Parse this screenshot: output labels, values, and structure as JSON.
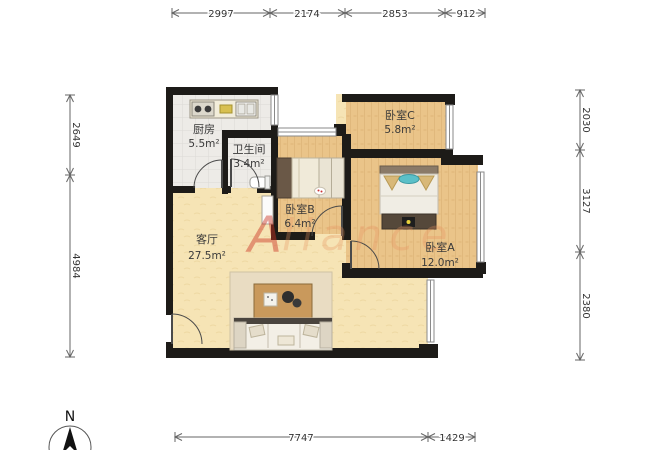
{
  "rooms": {
    "kitchen": {
      "name": "厨房",
      "area": "5.5m²"
    },
    "bathroom": {
      "name": "卫生间",
      "area": "3.4m²"
    },
    "bedroom_c": {
      "name": "卧室C",
      "area": "5.8m²"
    },
    "bedroom_b": {
      "name": "卧室B",
      "area": "6.4m²"
    },
    "bedroom_a": {
      "name": "卧室A",
      "area": "12.0m²"
    },
    "living_room": {
      "name": "客厅",
      "area": "27.5m²"
    }
  },
  "dimensions": {
    "top": [
      "2997",
      "2174",
      "2853",
      "912"
    ],
    "right": [
      "2030",
      "3127",
      "2380"
    ],
    "left": [
      "2649",
      "4984"
    ],
    "bottom": [
      "7747",
      "1429"
    ]
  },
  "compass": {
    "label": "N"
  },
  "watermark": {
    "first": "A",
    "rest": "liance"
  },
  "colors": {
    "wall": "#1d1b18",
    "living_floor": "#f6e4b5",
    "wood_floor": "#eac489",
    "tile_floor": "#edebe7",
    "rug": "#e9dcc2",
    "watermark_first": "#cc3322",
    "watermark_rest": "#e8925f"
  }
}
